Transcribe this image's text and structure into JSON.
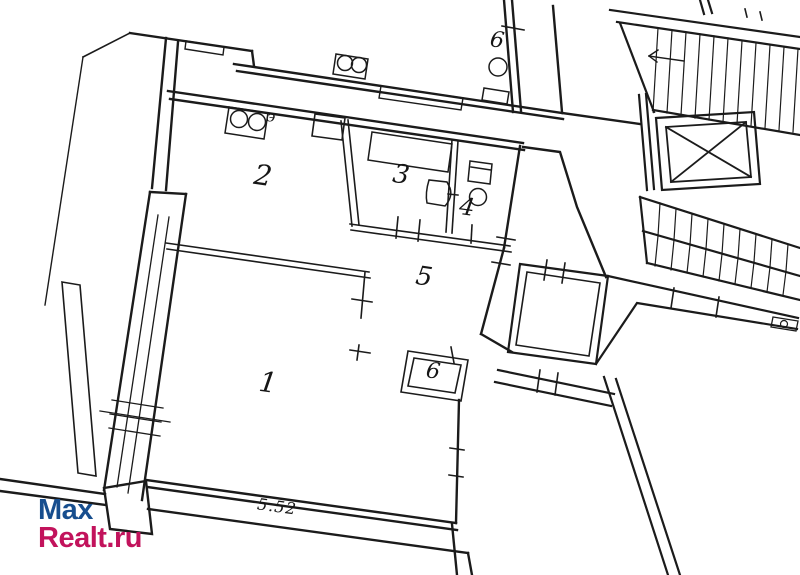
{
  "meta": {
    "kind": "apartment floor plan scan",
    "background": "#ffffff",
    "line_color": "#1b1b1b"
  },
  "watermark": {
    "line1": "Max",
    "line2": "Realt.ru",
    "color_line1": "#174e8e",
    "color_line2": "#c2135c"
  },
  "plan": {
    "rotation_deg": 8,
    "dimension_label": "5.52",
    "stove_label": "э",
    "rooms": [
      {
        "number": "1",
        "type": "living-room"
      },
      {
        "number": "2",
        "type": "kitchen"
      },
      {
        "number": "3",
        "type": "bathroom"
      },
      {
        "number": "4",
        "type": "toilet"
      },
      {
        "number": "5",
        "type": "hallway"
      },
      {
        "number": "6",
        "type": "storage"
      },
      {
        "number": "6",
        "type": "neighbor-toilet"
      }
    ],
    "fixtures": [
      "stove-icon",
      "bathtub-icon",
      "sink-icon",
      "toilet-icon",
      "elevator-icon",
      "stairs-icon",
      "direction-arrow-icon"
    ]
  }
}
